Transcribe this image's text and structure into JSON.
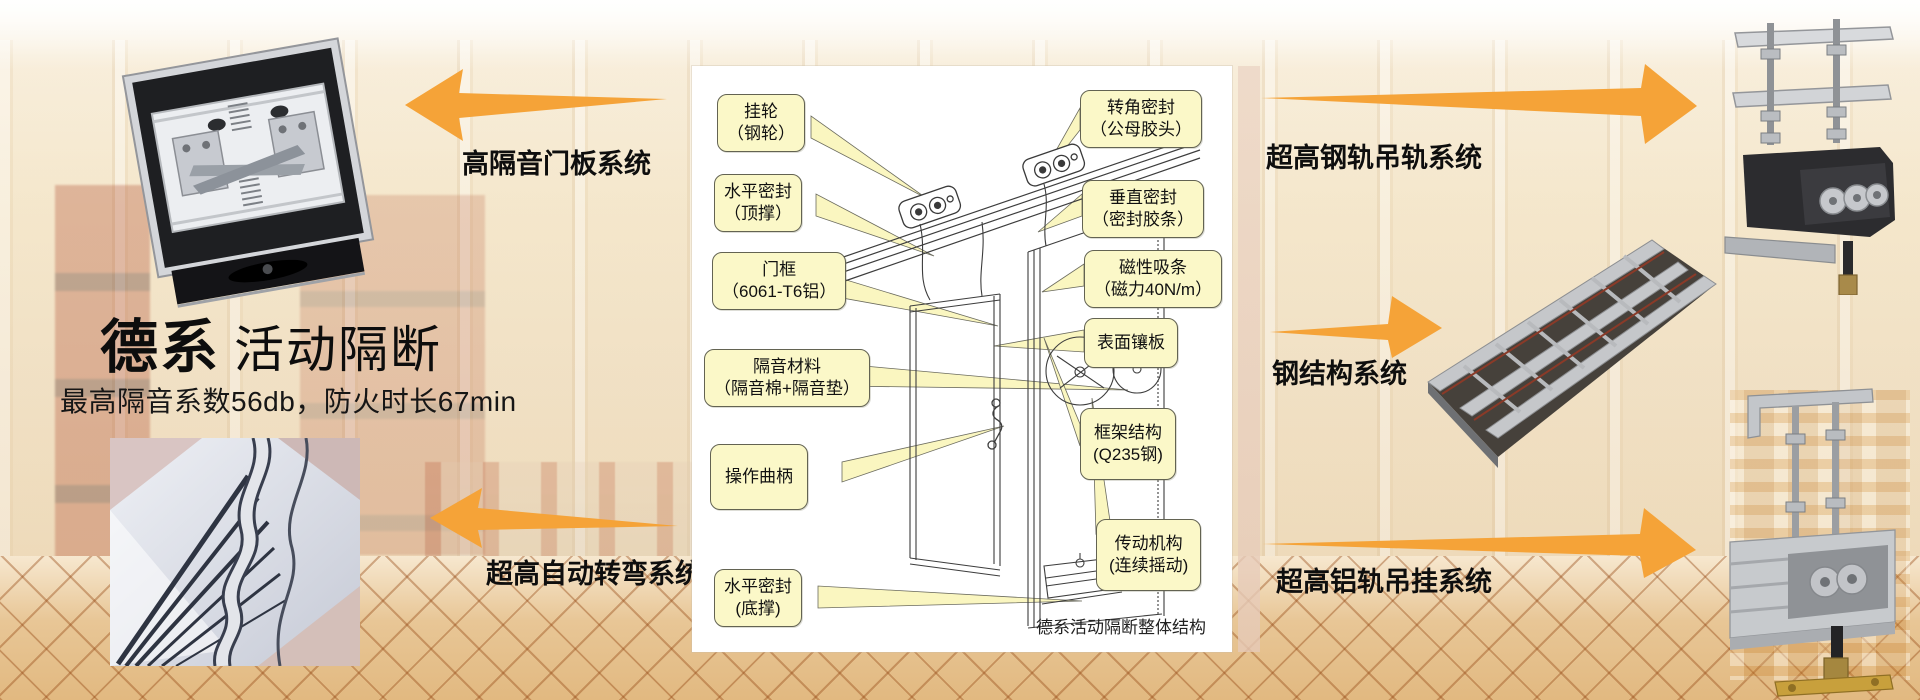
{
  "brand": {
    "title_primary": "德系",
    "title_secondary": "活动隔断",
    "subtitle": "最高隔音系数56db，防火时长67min"
  },
  "systems": [
    {
      "label": "高隔音门板系统",
      "direction": "left"
    },
    {
      "label": "超高钢轨吊轨系统",
      "direction": "right"
    },
    {
      "label": "钢结构系统",
      "direction": "right"
    },
    {
      "label": "超高自动转弯系统",
      "direction": "left"
    },
    {
      "label": "超高铝轨吊挂系统",
      "direction": "right"
    }
  ],
  "diagram": {
    "caption": "德系活动隔断整体结构",
    "callouts_left": [
      {
        "line1": "挂轮",
        "line2": "（钢轮）"
      },
      {
        "line1": "水平密封",
        "line2": "（顶撑）"
      },
      {
        "line1": "门框",
        "line2": "（6061-T6铝）"
      },
      {
        "line1": "隔音材料",
        "line2": "（隔音棉+隔音垫）"
      },
      {
        "line1": "操作曲柄",
        "line2": ""
      },
      {
        "line1": "水平密封",
        "line2": "(底撑)"
      }
    ],
    "callouts_right": [
      {
        "line1": "转角密封",
        "line2": "（公母胶头）"
      },
      {
        "line1": "垂直密封",
        "line2": "（密封胶条）"
      },
      {
        "line1": "磁性吸条",
        "line2": "（磁力40N/m）"
      },
      {
        "line1": "表面镶板",
        "line2": ""
      },
      {
        "line1": "框架结构",
        "line2": "(Q235钢)"
      },
      {
        "line1": "传动机构",
        "line2": "(连续摇动)"
      }
    ]
  },
  "photos": {
    "top_left": "door-top-mechanism",
    "bottom_left": "curved-track-ceiling",
    "right_top": "steel-rail-hanger",
    "right_middle": "steel-structure-frame",
    "right_bottom": "aluminum-rail-hanger"
  },
  "colors": {
    "arrow": "#F5A338",
    "callout_bg": "#FBF8C8",
    "callout_border": "#636352"
  }
}
